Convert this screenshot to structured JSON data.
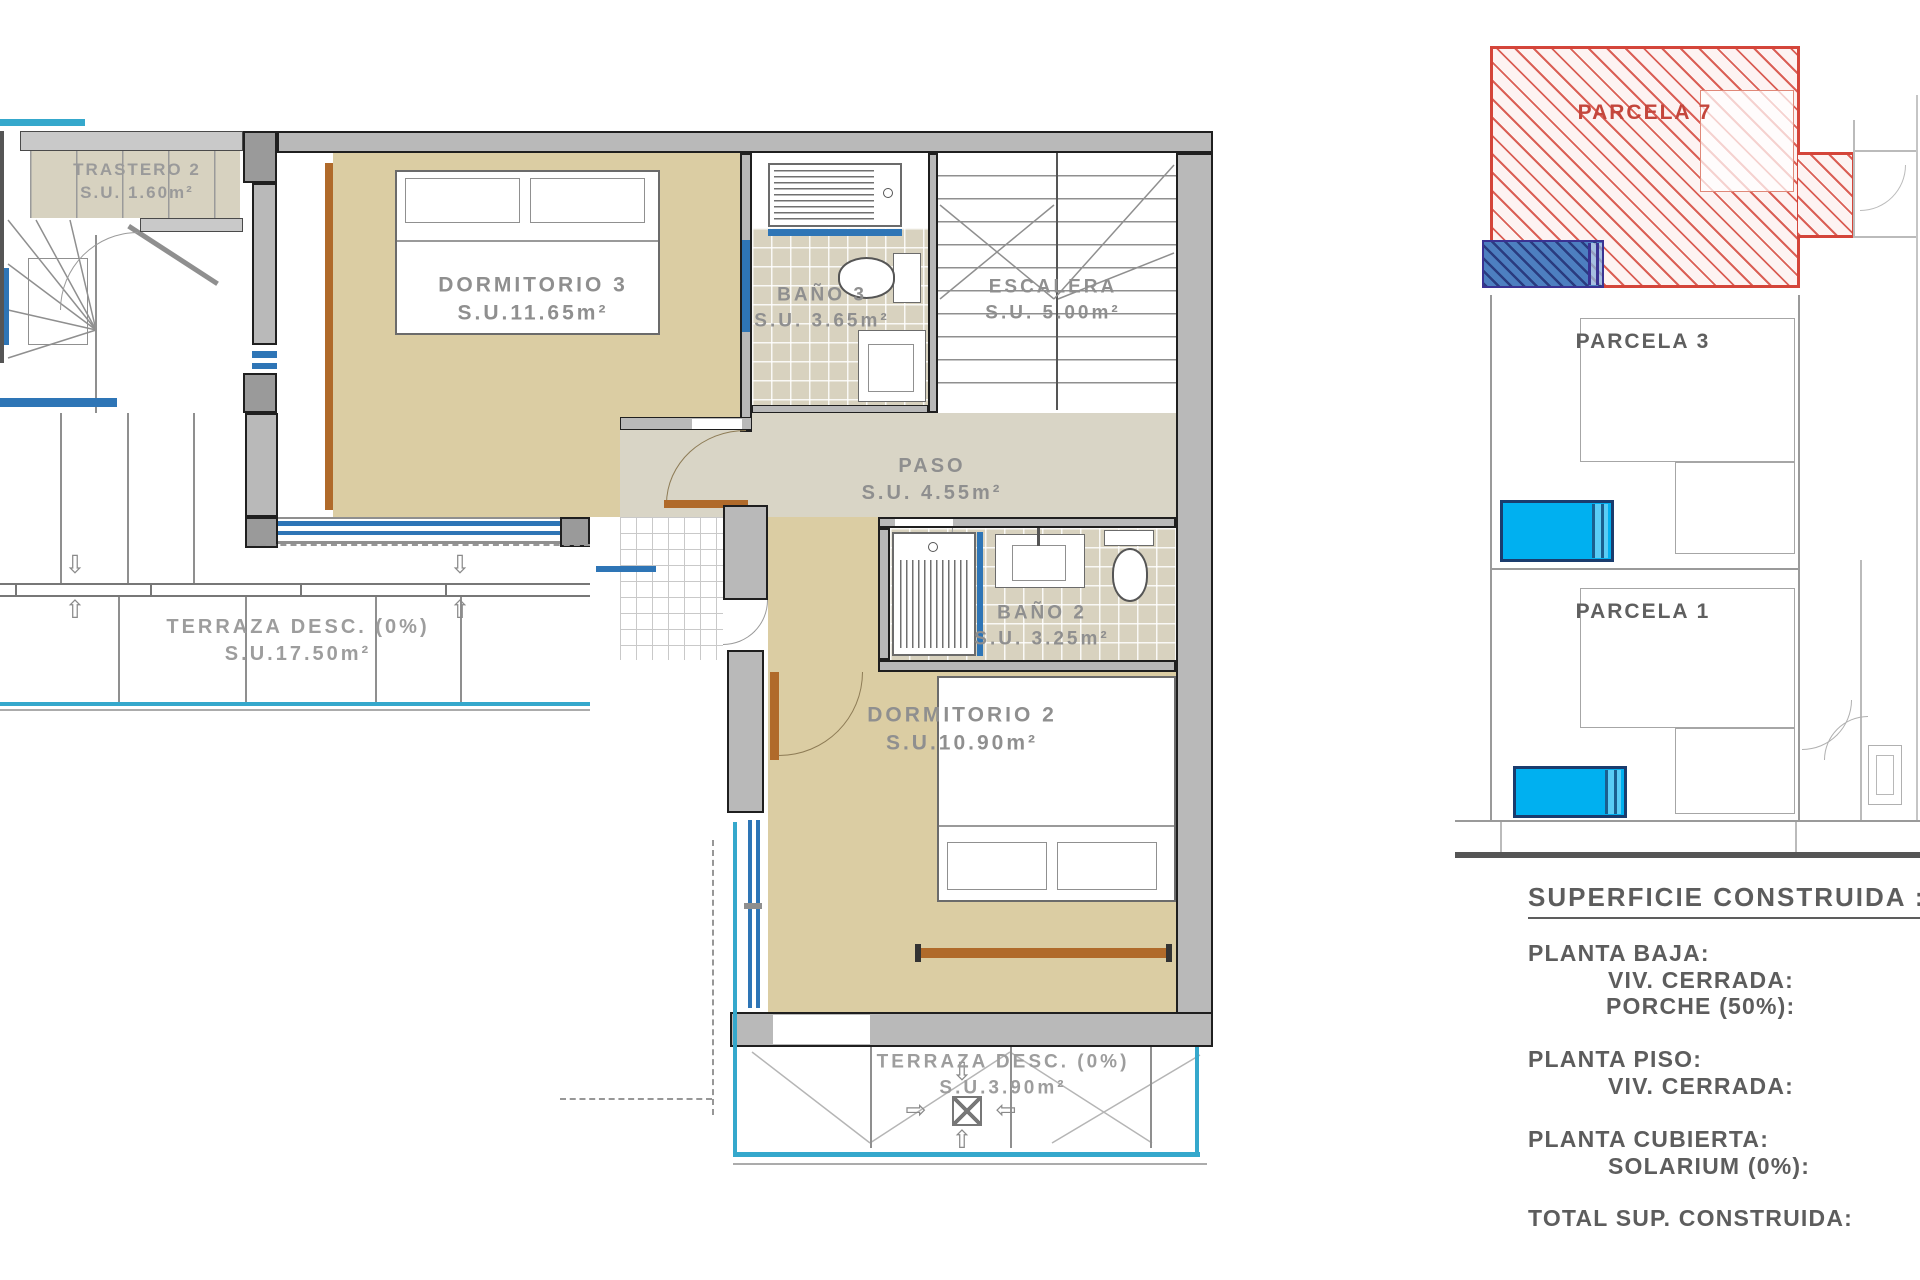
{
  "rooms": {
    "trastero2": {
      "name": "TRASTERO 2",
      "area": "S.U. 1.60m²"
    },
    "dormitorio3": {
      "name": "DORMITORIO 3",
      "area": "S.U.11.65m²"
    },
    "bano3": {
      "name": "BAÑO 3",
      "area": "S.U. 3.65m²"
    },
    "escalera": {
      "name": "ESCALERA",
      "area": "S.U. 5.00m²"
    },
    "paso": {
      "name": "PASO",
      "area": "S.U. 4.55m²"
    },
    "bano2": {
      "name": "BAÑO 2",
      "area": "S.U. 3.25m²"
    },
    "dormitorio2": {
      "name": "DORMITORIO 2",
      "area": "S.U.10.90m²"
    },
    "terraza_izquierda": {
      "name": "TERRAZA DESC. (0%)",
      "area": "S.U.17.50m²"
    },
    "terraza_inferior": {
      "name": "TERRAZA DESC. (0%)",
      "area": "S.U.3.90m²"
    }
  },
  "site_plan": {
    "parcela7": {
      "label": "PARCELA 7"
    },
    "parcela3": {
      "label": "PARCELA 3"
    },
    "parcela1": {
      "label": "PARCELA 1"
    }
  },
  "summary": {
    "heading": "SUPERFICIE CONSTRUIDA :",
    "lines": [
      "PLANTA BAJA:",
      "VIV. CERRADA:",
      "PORCHE (50%):",
      "PLANTA PISO:",
      "VIV. CERRADA:",
      "PLANTA CUBIERTA:",
      "SOLARIUM (0%):",
      "TOTAL SUP. CONSTRUIDA:"
    ]
  },
  "glyphs": {
    "arrow_up": "⇧",
    "arrow_down": "⇩",
    "arrow_left": "⇦",
    "arrow_right": "⇨"
  },
  "colors": {
    "parcel_highlight_red": "#d4453a",
    "parcel_hatch_blue": "#4d7fc0",
    "pool_blue": "#00b0f0",
    "window_blue": "#2e75b6",
    "railing_cyan": "#35a8cc",
    "floor_tan": "#dbcda3",
    "wall_gray": "#b9b9b9",
    "door_brown": "#b06a2a",
    "label_gray": "#8f8f8f"
  }
}
